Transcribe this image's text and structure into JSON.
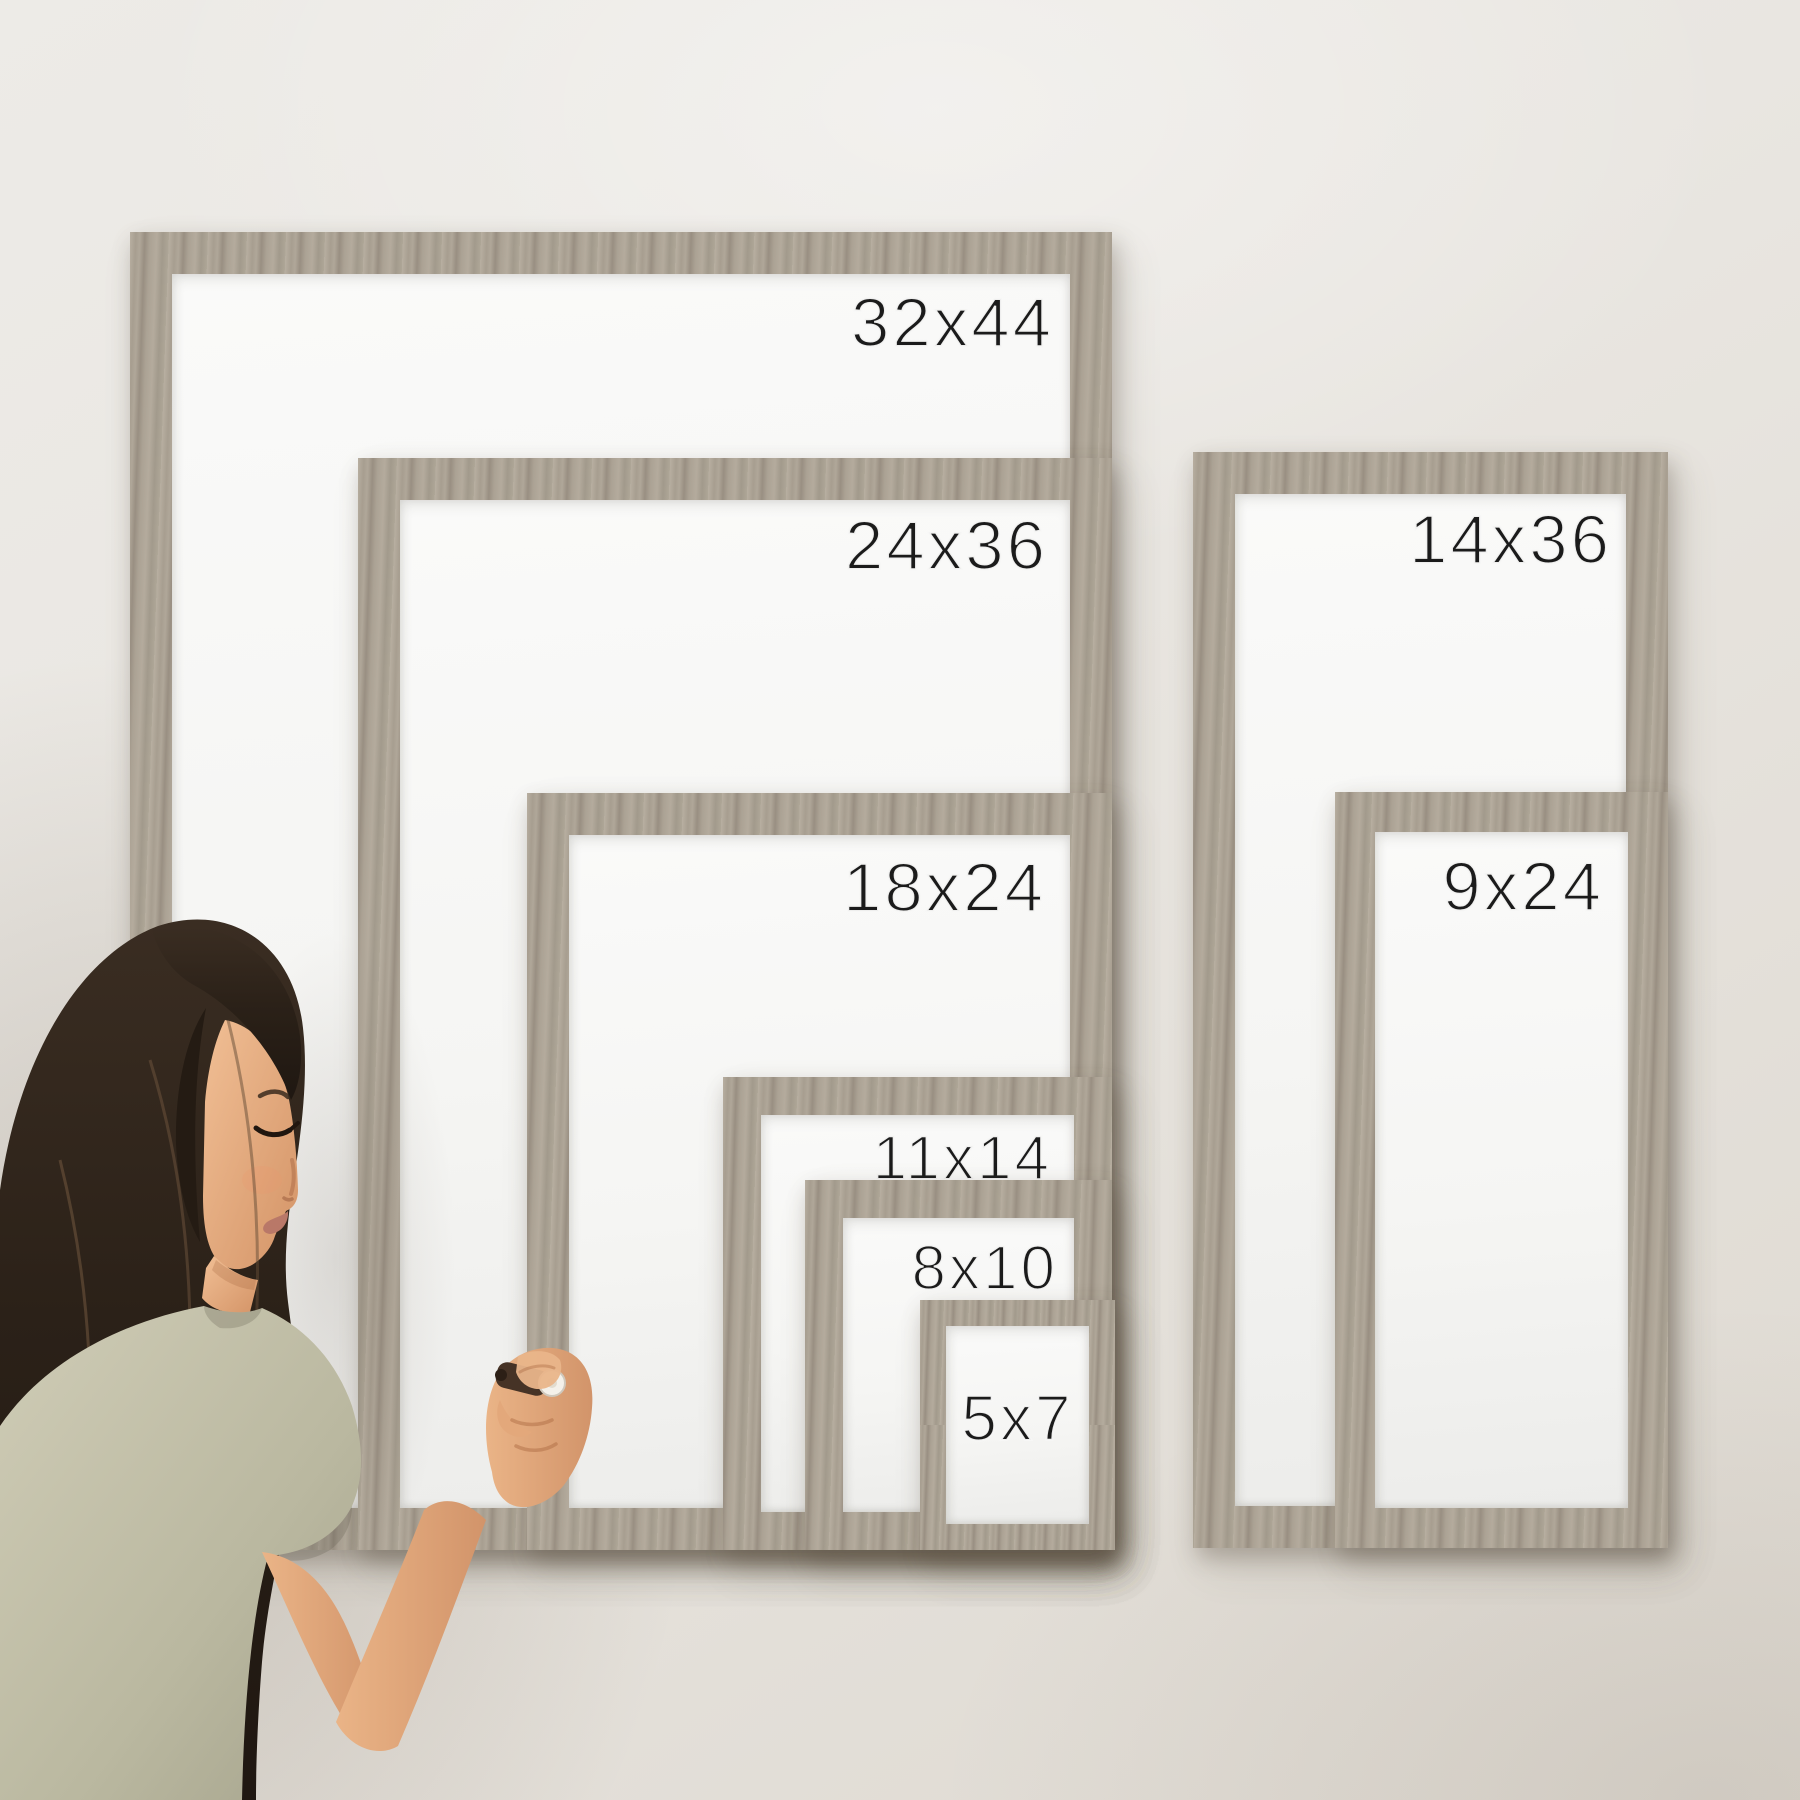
{
  "scene_title": "Whiteboard frame size comparison",
  "frames": [
    {
      "id": "32x44",
      "label": "32x44",
      "left": 130,
      "top": 232,
      "width": 982,
      "height": 1318,
      "border": 42,
      "font_size": 69,
      "label_mt": 14,
      "label_mr": 16,
      "label_align": "right"
    },
    {
      "id": "24x36",
      "label": "24x36",
      "left": 358,
      "top": 458,
      "width": 754,
      "height": 1092,
      "border": 42,
      "font_size": 69,
      "label_mt": 11,
      "label_mr": 22,
      "label_align": "right"
    },
    {
      "id": "18x24",
      "label": "18x24",
      "left": 527,
      "top": 793,
      "width": 585,
      "height": 757,
      "border": 42,
      "font_size": 69,
      "label_mt": 18,
      "label_mr": 24,
      "label_align": "right"
    },
    {
      "id": "11x14",
      "label": "11x14",
      "left": 723,
      "top": 1077,
      "width": 389,
      "height": 473,
      "border": 38,
      "font_size": 62,
      "label_mt": 13,
      "label_mr": 22,
      "label_align": "right"
    },
    {
      "id": "8x10",
      "label": "8x10",
      "left": 805,
      "top": 1180,
      "width": 307,
      "height": 370,
      "border": 38,
      "font_size": 62,
      "label_mt": 20,
      "label_mr": 16,
      "label_align": "right"
    },
    {
      "id": "5x7",
      "label": "5x7",
      "left": 920,
      "top": 1300,
      "width": 195,
      "height": 250,
      "border": 26,
      "font_size": 64,
      "label_mt": 60,
      "label_mr": 0,
      "label_align": "center"
    },
    {
      "id": "14x36",
      "label": "14x36",
      "left": 1193,
      "top": 452,
      "width": 475,
      "height": 1096,
      "border": 42,
      "font_size": 69,
      "label_mt": 11,
      "label_mr": 14,
      "label_align": "right"
    },
    {
      "id": "9x24",
      "label": "9x24",
      "left": 1335,
      "top": 792,
      "width": 333,
      "height": 756,
      "border": 40,
      "font_size": 69,
      "label_mt": 20,
      "label_mr": 24,
      "label_align": "right"
    }
  ],
  "colors": {
    "wall_top": "#edebe7",
    "wall_mid": "#e9e6e1",
    "wall_bottom": "#ded9d1",
    "wood_light": "#b8afa1",
    "wood_mid": "#a79e90",
    "wood_dark": "#998f82",
    "board": "#f6f6f4",
    "label_text": "#1b1b1b",
    "hair_dark": "#1f1711",
    "hair_mid": "#2b2118",
    "hair_strand": "#5c4632",
    "skin_light": "#f1bf95",
    "skin_dark": "#d49467",
    "shirt_light": "#cfccb6",
    "shirt_dark": "#a5a38c",
    "marker_body": "#463326",
    "marker_cap": "#f4f1ea",
    "lips": "#b97868"
  }
}
